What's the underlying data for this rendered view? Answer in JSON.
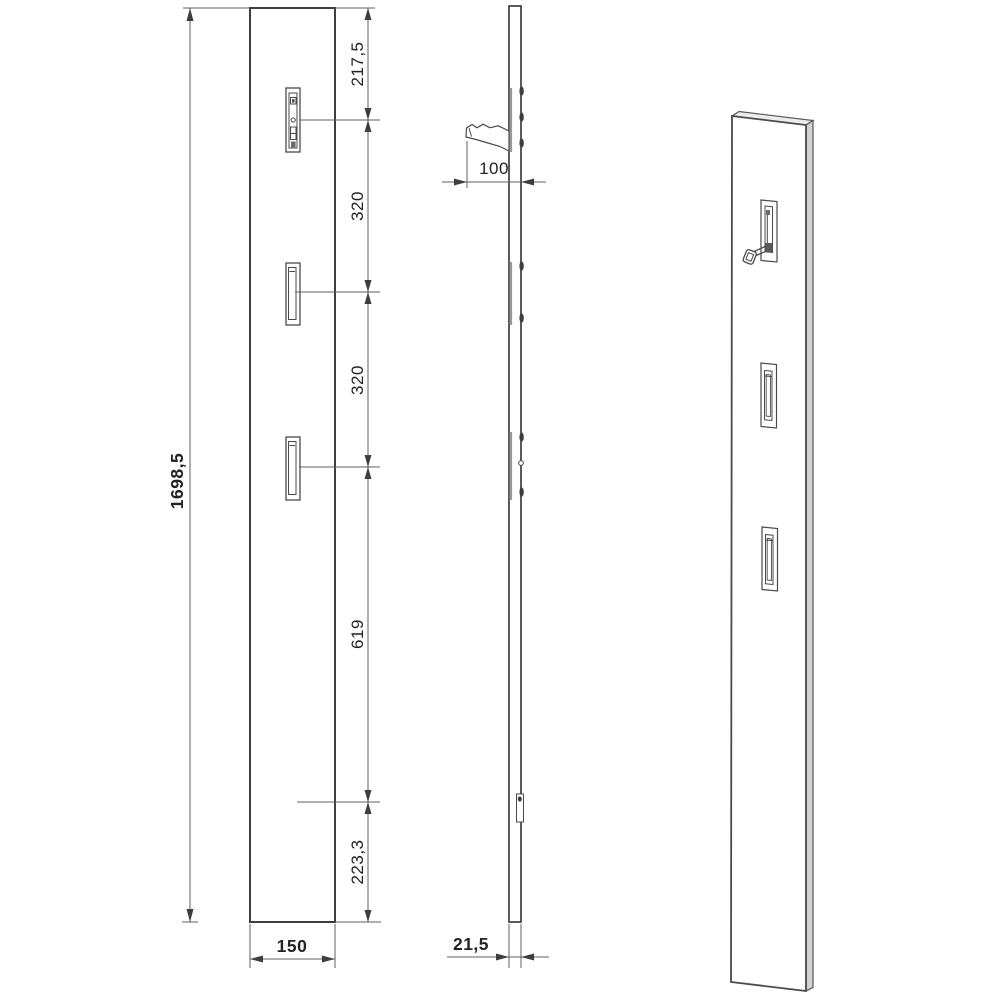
{
  "front_view": {
    "total_height": "1698,5",
    "width": "150",
    "segments_top_to_bottom": [
      "217,5",
      "320",
      "320",
      "619",
      "223,3"
    ]
  },
  "side_view": {
    "hook_projection": "100",
    "thickness": "21,5"
  },
  "colors": {
    "background": "#ffffff",
    "outline": "#3e3e3e",
    "dimension_line": "#5f5f5f",
    "text": "#222222",
    "panel_side_shading": "#d2d2d2",
    "panel_top_shading": "#ececec",
    "rail_gray": "#999999"
  }
}
